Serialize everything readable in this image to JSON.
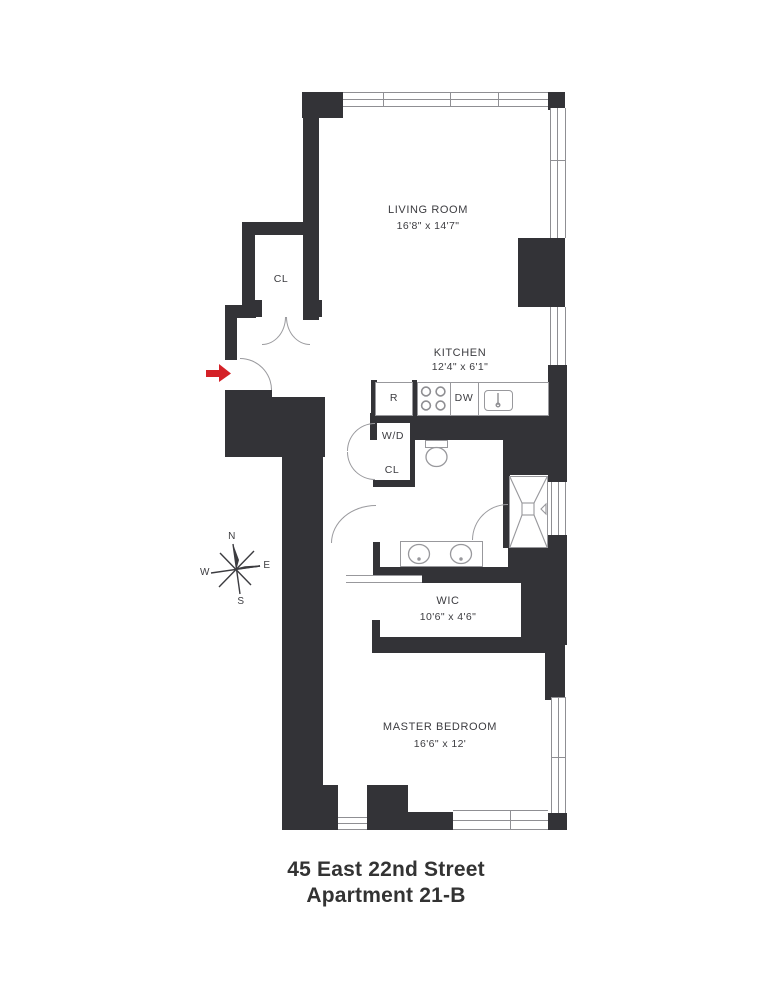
{
  "title": {
    "line1": "45 East 22nd Street",
    "line2": "Apartment 21-B"
  },
  "rooms": {
    "living": {
      "name": "LIVING ROOM",
      "dims": "16'8\" x 14'7\""
    },
    "kitchen": {
      "name": "KITCHEN",
      "dims": "12'4\" x 6'1\""
    },
    "wic": {
      "name": "WIC",
      "dims": "10'6\" x 4'6\""
    },
    "bedroom": {
      "name": "MASTER BEDROOM",
      "dims": "16'6\" x 12'"
    },
    "entry_closet": {
      "name": "CL"
    },
    "laundry": {
      "name": "W/D"
    },
    "laundry_closet": {
      "name": "CL"
    }
  },
  "appliances": {
    "refrigerator": "R",
    "dishwasher": "DW"
  },
  "compass": {
    "n": "N",
    "s": "S",
    "e": "E",
    "w": "W"
  },
  "colors": {
    "wall": "#333337",
    "fixture_line": "#98989c",
    "entry_arrow": "#d42127",
    "text": "#3c3c40"
  }
}
